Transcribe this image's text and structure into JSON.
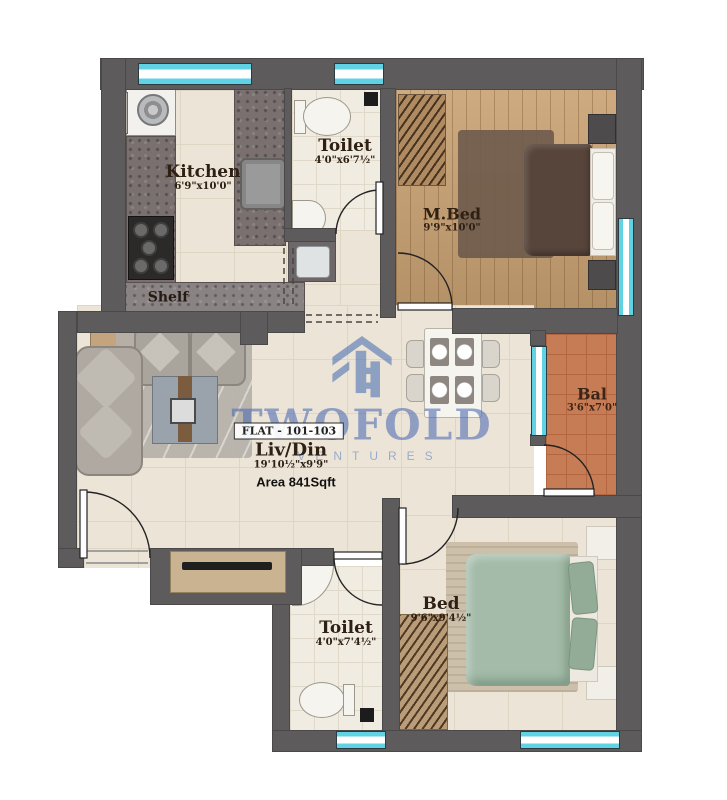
{
  "watermark": {
    "brand": "TWOFOLD",
    "subtitle": "VENTURES"
  },
  "badge": {
    "flat": "FLAT - 101-103",
    "area": "Area 841Sqft"
  },
  "rooms": {
    "kitchen": {
      "label": "Kitchen",
      "dims": "6'9\"x10'0\""
    },
    "toilet_top": {
      "label": "Toilet",
      "dims": "4'0\"x6'7½\""
    },
    "master_bed": {
      "label": "M.Bed",
      "dims": "9'9\"x10'0\""
    },
    "balcony": {
      "label": "Bal",
      "dims": "3'6\"x7'0\""
    },
    "living_dining": {
      "label": "Liv/Din",
      "dims": "19'10½\"x9'9\""
    },
    "bed": {
      "label": "Bed",
      "dims": "9'6\"x9'4½\""
    },
    "toilet_bottom": {
      "label": "Toilet",
      "dims": "4'0\"x7'4½\""
    },
    "shelf": {
      "label": "Shelf"
    }
  },
  "colors": {
    "wall": "#5e5b5d",
    "window_glass": "#5fd2e4",
    "floor_tile": "#ece5d7",
    "wood_floor": "#c9a173",
    "balcony_tile": "#c67d55",
    "watermark_blue": "#4a69b2"
  }
}
